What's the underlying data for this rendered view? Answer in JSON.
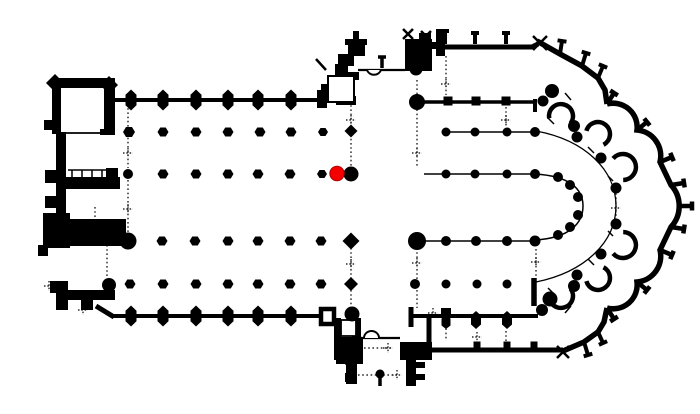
{
  "plan": {
    "canvas": {
      "width": 700,
      "height": 414
    },
    "colors": {
      "background": "#ffffff",
      "ink": "#000000",
      "marker_fill": "#f40000",
      "marker_stroke": "#b00000"
    },
    "marker": {
      "x": 337,
      "y": 173.5,
      "r": 7.2
    },
    "apse_center": {
      "x": 540,
      "y": 206
    },
    "geometry": {
      "dotted_segments": [
        [
          128,
          104,
          128,
          168
        ],
        [
          128,
          180,
          128,
          235
        ],
        [
          95,
          207,
          95,
          231
        ],
        [
          107,
          245,
          107,
          287
        ],
        [
          58,
          205,
          58,
          218
        ],
        [
          351,
          80,
          351,
          168
        ],
        [
          417,
          80,
          417,
          168
        ],
        [
          351,
          248,
          351,
          306
        ],
        [
          417,
          248,
          417,
          308
        ],
        [
          446,
          56,
          446,
          95
        ],
        [
          446,
          320,
          446,
          341
        ],
        [
          506,
          107,
          506,
          127
        ],
        [
          506,
          331,
          506,
          346
        ],
        [
          536,
          249,
          536,
          276
        ],
        [
          616,
          189,
          616,
          223
        ],
        [
          358,
          375,
          397,
          375
        ],
        [
          364,
          348,
          392,
          348
        ],
        [
          330,
          96,
          330,
          104
        ]
      ],
      "plus_marks": [
        [
          128,
          153
        ],
        [
          128,
          209
        ],
        [
          49,
          286
        ],
        [
          83,
          310
        ],
        [
          351,
          120
        ],
        [
          417,
          153
        ],
        [
          351,
          264
        ],
        [
          417,
          263
        ],
        [
          446,
          84
        ],
        [
          506,
          120
        ],
        [
          536,
          262
        ],
        [
          477,
          337
        ],
        [
          433,
          313
        ],
        [
          388,
          348
        ],
        [
          397,
          375
        ],
        [
          616,
          208
        ]
      ],
      "rib_ticks": [
        [
          565,
          93,
          571,
          100,
          1.5
        ],
        [
          548,
          118,
          554,
          124,
          1.5
        ],
        [
          588,
          147,
          594,
          153,
          1.5
        ],
        [
          608,
          176,
          613,
          181,
          1.5
        ],
        [
          608,
          231,
          613,
          236,
          1.5
        ],
        [
          588,
          259,
          594,
          265,
          1.5
        ],
        [
          548,
          288,
          554,
          294,
          1.5
        ],
        [
          565,
          313,
          571,
          306,
          1.5
        ]
      ],
      "thin_segments": [
        [
          61,
          133,
          104,
          133,
          1.8
        ],
        [
          68,
          170,
          106,
          170,
          1.5
        ],
        [
          72,
          170,
          72,
          177,
          1.5
        ],
        [
          82,
          170,
          82,
          177,
          1.5
        ],
        [
          92,
          170,
          92,
          177,
          1.5
        ],
        [
          102,
          170,
          102,
          177,
          1.5
        ],
        [
          358,
          70,
          405,
          70,
          2.2
        ],
        [
          361,
          338,
          400,
          338,
          2.2
        ],
        [
          443,
          132,
          535,
          132,
          1.5
        ],
        [
          424,
          174,
          535,
          174,
          1.5
        ],
        [
          424,
          241,
          535,
          241,
          1.5
        ],
        [
          316,
          59,
          326,
          70,
          2.5
        ]
      ],
      "thin_paths": [
        [
          "M535,174 C570,176 583,189 583,206 C583,223 570,238 535,240",
          1.5
        ],
        [
          "M536,131 C585,140 616,170 616,206 C616,242 585,272 536,282",
          1.3
        ]
      ],
      "wall_segments": [
        [
          113,
          100,
          318,
          100,
          4
        ],
        [
          112,
          316,
          320,
          316,
          4
        ],
        [
          436,
          47,
          534,
          47,
          5
        ],
        [
          432,
          350,
          563,
          350,
          5
        ],
        [
          420,
          102,
          535,
          102,
          3.5
        ],
        [
          535,
          99,
          535,
          112,
          4
        ],
        [
          411,
          316,
          538,
          316,
          4
        ],
        [
          324,
          84,
          324,
          104,
          6
        ],
        [
          429,
          316,
          429,
          348,
          5
        ],
        [
          411,
          307,
          411,
          327,
          5
        ],
        [
          534,
          278,
          534,
          306,
          5.5
        ],
        [
          96,
          306,
          114,
          317,
          5
        ],
        [
          339,
          357,
          348,
          364,
          4
        ],
        [
          380,
          378,
          380,
          386,
          3.5
        ],
        [
          532,
          47,
          538,
          44,
          5
        ],
        [
          356,
          31,
          356,
          46,
          6
        ],
        [
          345,
          42,
          367,
          42,
          6
        ]
      ],
      "rim_paths": [
        [
          "M537,41 L560,54 L582,66 L598,78 L605,90 L607,104",
          5.5
        ],
        [
          "M563,351 L584,342 L598,332 L604,322 L607,308",
          5.5
        ],
        [
          "M607,104 A24,24 0 0 1 637,130 A26,26 0 0 1 660,162 L671,185 A31,31 0 0 1 671,227 L660,250 A26,26 0 0 1 637,282 A24,24 0 0 1 607,308",
          5.5
        ]
      ],
      "door_arcs": [
        [
          "M367,70 A7.5,7.5 0 0 0 381,70",
          2
        ],
        [
          "M364,338 A7.5,7 0 0 1 379,338",
          2
        ]
      ],
      "chapel_lobes": [
        [
          561,
          116,
          12
        ],
        [
          598,
          134,
          12
        ],
        [
          623,
          167,
          13
        ],
        [
          623,
          245,
          13
        ],
        [
          598,
          278,
          12
        ],
        [
          561,
          296,
          12
        ]
      ],
      "rects": [
        [
          52,
          78,
          63,
          10
        ],
        [
          52,
          78,
          9,
          56
        ],
        [
          104,
          78,
          11,
          57
        ],
        [
          44,
          120,
          8,
          10
        ],
        [
          100,
          129,
          10,
          6
        ],
        [
          56,
          132,
          10,
          97
        ],
        [
          45,
          170,
          11,
          13
        ],
        [
          45,
          196,
          11,
          12
        ],
        [
          66,
          177,
          54,
          12
        ],
        [
          106,
          168,
          12,
          21
        ],
        [
          47,
          219,
          79,
          27
        ],
        [
          43,
          213,
          27,
          35
        ],
        [
          38,
          245,
          10,
          11
        ],
        [
          50,
          281,
          18,
          12
        ],
        [
          56,
          290,
          59,
          10
        ],
        [
          56,
          300,
          12,
          10
        ],
        [
          81,
          300,
          12,
          10
        ],
        [
          348,
          44,
          17,
          12
        ],
        [
          338,
          54,
          16,
          12
        ],
        [
          335,
          64,
          13,
          12
        ],
        [
          347,
          72,
          12,
          8
        ],
        [
          317,
          90,
          10,
          18
        ],
        [
          336,
          96,
          20,
          9
        ],
        [
          405,
          39,
          27,
          32
        ],
        [
          419,
          33,
          12,
          10
        ],
        [
          436,
          29,
          9,
          27
        ],
        [
          428,
          42,
          9,
          7
        ],
        [
          334,
          318,
          7,
          42
        ],
        [
          352,
          318,
          9,
          33
        ],
        [
          336,
          337,
          27,
          27
        ],
        [
          346,
          364,
          11,
          20
        ],
        [
          345,
          373,
          8,
          9
        ],
        [
          400,
          342,
          32,
          18
        ],
        [
          406,
          360,
          10,
          26
        ],
        [
          416,
          362,
          9,
          6
        ],
        [
          416,
          374,
          9,
          6
        ]
      ],
      "outline_rects": [
        [
          328,
          76,
          26,
          26,
          2
        ],
        [
          341,
          320,
          15,
          16,
          1.8
        ],
        [
          321,
          309,
          13,
          15,
          4.5
        ]
      ],
      "squares": [
        [
          448,
          101,
          9
        ],
        [
          476,
          101,
          9
        ],
        [
          506,
          101,
          9
        ],
        [
          446,
          313,
          10
        ],
        [
          477,
          345,
          7
        ],
        [
          507,
          345,
          7
        ],
        [
          534,
          345,
          7
        ]
      ],
      "diamonds": [
        [
          55,
          83,
          9
        ],
        [
          109,
          85,
          9
        ],
        [
          351,
          131,
          6.5
        ],
        [
          351,
          241,
          8.5
        ],
        [
          351,
          284,
          7
        ]
      ],
      "wall_buttresses": [
        [
          131,
          100,
          11,
          21
        ],
        [
          163,
          100,
          11,
          21
        ],
        [
          196,
          100,
          11,
          21
        ],
        [
          228,
          100,
          11,
          21
        ],
        [
          258,
          100,
          11,
          21
        ],
        [
          291,
          100,
          11,
          21
        ],
        [
          131,
          316,
          11,
          21
        ],
        [
          163,
          316,
          11,
          21
        ],
        [
          196,
          316,
          11,
          21
        ],
        [
          228,
          316,
          11,
          21
        ],
        [
          258,
          316,
          11,
          21
        ],
        [
          291,
          316,
          11,
          21
        ],
        [
          446,
          322,
          9,
          14
        ],
        [
          476,
          320,
          10,
          18
        ],
        [
          507,
          320,
          10,
          18
        ]
      ],
      "pointed_columns": [
        [
          129,
          132,
          12,
          10
        ],
        [
          163,
          132,
          11,
          9
        ],
        [
          196,
          132,
          11,
          9
        ],
        [
          228,
          132,
          11,
          9
        ],
        [
          260,
          132,
          11,
          9
        ],
        [
          291,
          132,
          11,
          9
        ],
        [
          323,
          132,
          10,
          8
        ],
        [
          163,
          174,
          11,
          9
        ],
        [
          196,
          174,
          11,
          9
        ],
        [
          228,
          174,
          11,
          9
        ],
        [
          258,
          174,
          11,
          9
        ],
        [
          290,
          174,
          11,
          9
        ],
        [
          322,
          174,
          10,
          8
        ],
        [
          162,
          241,
          11,
          9
        ],
        [
          195,
          241,
          11,
          9
        ],
        [
          228,
          241,
          11,
          9
        ],
        [
          258,
          241,
          11,
          9
        ],
        [
          290,
          241,
          11,
          9
        ],
        [
          321,
          241,
          11,
          9
        ],
        [
          130,
          284,
          11,
          9
        ],
        [
          163,
          284,
          11,
          9
        ],
        [
          196,
          284,
          11,
          9
        ],
        [
          228,
          284,
          11,
          9
        ],
        [
          258,
          284,
          11,
          9
        ],
        [
          290,
          284,
          11,
          9
        ],
        [
          321,
          284,
          11,
          9
        ]
      ],
      "circles": [
        [
          128,
          174,
          5
        ],
        [
          128,
          241,
          8.5
        ],
        [
          109,
          285,
          7
        ],
        [
          351,
          174,
          7.5
        ],
        [
          417,
          102,
          8
        ],
        [
          417,
          241,
          9
        ],
        [
          352,
          314,
          7.5
        ],
        [
          416,
          69,
          6.5
        ],
        [
          446,
          132,
          4.5
        ],
        [
          475,
          132,
          4.5
        ],
        [
          507,
          132,
          4.5
        ],
        [
          535,
          132,
          5
        ],
        [
          446,
          174,
          4.5
        ],
        [
          475,
          174,
          4.5
        ],
        [
          507,
          174,
          4.5
        ],
        [
          535,
          174,
          5
        ],
        [
          446,
          241,
          5
        ],
        [
          476,
          241,
          5
        ],
        [
          507,
          241,
          5
        ],
        [
          535,
          241,
          5.5
        ],
        [
          415,
          284,
          5
        ],
        [
          446,
          284,
          4.5
        ],
        [
          477,
          284,
          4.5
        ],
        [
          507,
          284,
          4.5
        ],
        [
          558,
          177,
          5
        ],
        [
          570,
          185,
          5
        ],
        [
          578,
          197,
          5
        ],
        [
          578,
          215,
          5
        ],
        [
          570,
          227,
          5
        ],
        [
          558,
          235,
          5
        ],
        [
          577,
          137,
          5.5
        ],
        [
          601,
          158,
          5.5
        ],
        [
          616,
          188,
          5.5
        ],
        [
          616,
          224,
          5.5
        ],
        [
          601,
          254,
          5.5
        ],
        [
          577,
          275,
          5.5
        ],
        [
          552,
          91,
          7
        ],
        [
          543,
          101,
          5.5
        ],
        [
          574,
          126,
          6
        ],
        [
          550,
          299,
          7.5
        ],
        [
          542,
          310,
          6
        ],
        [
          574,
          286,
          6
        ],
        [
          380,
          374,
          4.5
        ]
      ],
      "tees": [
        [
          445,
          44,
          445,
          31,
          8,
          4
        ],
        [
          475,
          44,
          475,
          33,
          8,
          4
        ],
        [
          506,
          44,
          506,
          33,
          8,
          4
        ],
        [
          382,
          68,
          382,
          57,
          8,
          3.5
        ],
        [
          560,
          54,
          562,
          41,
          9,
          4
        ],
        [
          582,
          66,
          586,
          53,
          9,
          4
        ],
        [
          598,
          78,
          603,
          66,
          9,
          4
        ],
        [
          607,
          104,
          614,
          93,
          9,
          4.5
        ],
        [
          637,
          130,
          647,
          122,
          9,
          4.5
        ],
        [
          660,
          162,
          672,
          157,
          9,
          4.5
        ],
        [
          671,
          185,
          684,
          183,
          9,
          4.5
        ],
        [
          679,
          206,
          692,
          206,
          9,
          4.5
        ],
        [
          671,
          227,
          684,
          229,
          9,
          4.5
        ],
        [
          660,
          250,
          672,
          255,
          9,
          4.5
        ],
        [
          637,
          282,
          647,
          290,
          9,
          4.5
        ],
        [
          607,
          308,
          614,
          319,
          9,
          4.5
        ],
        [
          598,
          332,
          603,
          343,
          9,
          4
        ],
        [
          584,
          342,
          588,
          355,
          9,
          4
        ]
      ],
      "crosses": [
        [
          540,
          43,
          7
        ],
        [
          563,
          352,
          6
        ],
        [
          408,
          34,
          5
        ],
        [
          426,
          36,
          5
        ]
      ]
    }
  }
}
